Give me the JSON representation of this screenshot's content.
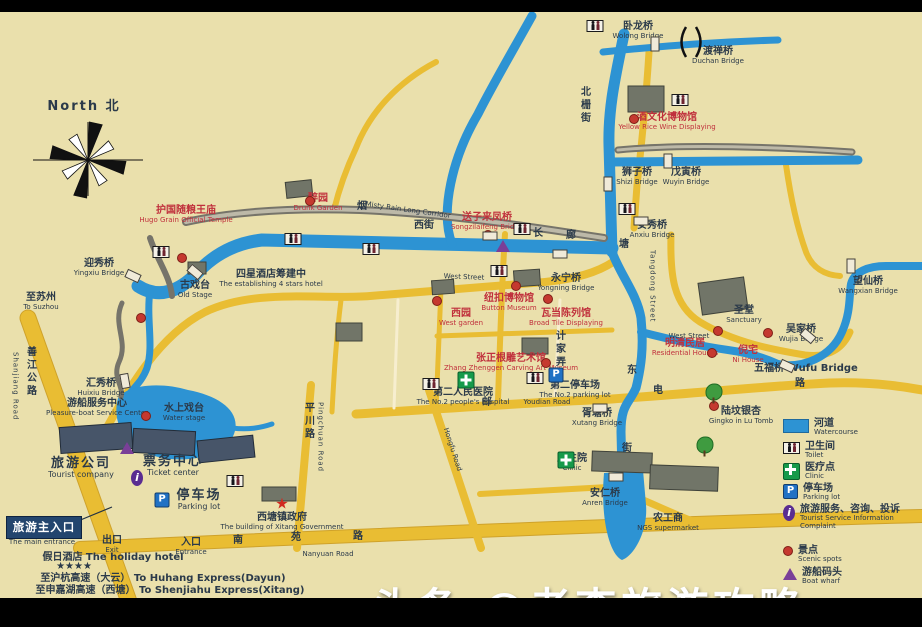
{
  "colors": {
    "background": "#eae0ac",
    "water": "#2d93d3",
    "road": "#e9bd33",
    "red_label": "#c0303c",
    "dark_label": "#2b3a4a",
    "entrance_box": "#23456e",
    "scenic_dot": "#c5392f",
    "clinic_green": "#169a4a",
    "parking_blue": "#2071c4",
    "info_purple": "#5a2d91",
    "wharf_purple": "#7a3f98",
    "watermark": "#ffffff"
  },
  "watermark": {
    "text": "头条 @老李旅游攻略"
  },
  "main_entrance": {
    "zh": "旅游主入口",
    "en": "The main entrance"
  },
  "legend": {
    "items": [
      {
        "icon": "water",
        "zh": "河道",
        "en": "Watercourse"
      },
      {
        "icon": "toilet",
        "zh": "卫生间",
        "en": "Toilet"
      },
      {
        "icon": "cross",
        "zh": "医疗点",
        "en": "Clinic"
      },
      {
        "icon": "parking",
        "zh": "停车场",
        "en": "Parking lot"
      },
      {
        "icon": "info",
        "zh": "旅游服务、咨询、投诉",
        "en": "Tourist Service Information Complaint"
      },
      {
        "icon": "dot",
        "zh": "景点",
        "en": "Scenic spots"
      },
      {
        "icon": "wharf",
        "zh": "游船码头",
        "en": "Boat wharf"
      }
    ]
  },
  "map": {
    "labels": [
      {
        "id": "wolong-bridge",
        "zh": "卧龙桥",
        "en": "Wolong Bridge",
        "x": 638,
        "y": 22
      },
      {
        "id": "duchan-bridge",
        "zh": "渡禅桥",
        "en": "Duchan Bridge",
        "x": 718,
        "y": 47
      },
      {
        "id": "wine-museum",
        "zh": "酒文化博物馆",
        "en": "Yellow Rice Wine Displaying",
        "x": 667,
        "y": 113,
        "red": true
      },
      {
        "id": "beizha-street",
        "zh": "北栅街",
        "x": 578,
        "y": 86,
        "vertical": true
      },
      {
        "id": "shizi-bridge",
        "zh": "狮子桥",
        "en": "Shizi Bridge",
        "x": 637,
        "y": 168
      },
      {
        "id": "wuyin-bridge",
        "zh": "戊寅桥",
        "en": "Wuyin Bridge",
        "x": 686,
        "y": 168
      },
      {
        "id": "anxiu-bridge",
        "zh": "安秀桥",
        "en": "Anxiu Bridge",
        "x": 652,
        "y": 221
      },
      {
        "id": "north-mark",
        "zh": "North 北",
        "x": 84,
        "y": 100,
        "big": true
      },
      {
        "id": "hugo-temple",
        "zh": "护国随粮王庙",
        "en": "Hugo Grain Official Temple",
        "x": 186,
        "y": 206,
        "red": true
      },
      {
        "id": "yingxiu-bridge",
        "zh": "迎秀桥",
        "en": "Yingxiu Bridge",
        "x": 99,
        "y": 259
      },
      {
        "id": "to-suzhou",
        "zh": "至苏州",
        "en": "To Suzhou",
        "x": 41,
        "y": 293
      },
      {
        "id": "shanjiang-road",
        "zh": "善江公路",
        "x": 24,
        "y": 346,
        "vertical": true
      },
      {
        "id": "shanjiang-road-en",
        "en": "Shanjiang Road",
        "x": 11,
        "y": 352,
        "vertical": true
      },
      {
        "id": "zuiyuan-garden",
        "zh": "醉园",
        "en": "Drunk Garden",
        "x": 318,
        "y": 194,
        "red": true
      },
      {
        "id": "corridor-char-yan",
        "zh": "烟",
        "x": 362,
        "y": 202
      },
      {
        "id": "corridor-en",
        "en": "Misty Rain Long Corridor",
        "x": 408,
        "y": 207,
        "rot": 8
      },
      {
        "id": "corridor-char-chang",
        "zh": "长",
        "x": 538,
        "y": 229
      },
      {
        "id": "corridor-char-lang",
        "zh": "廊",
        "x": 571,
        "y": 231
      },
      {
        "id": "songzi-laifeng-bridge",
        "zh": "送子来凤桥",
        "en": "Songzilaifeng Bridge",
        "x": 487,
        "y": 213,
        "red": true
      },
      {
        "id": "old-stage",
        "zh": "古戏台",
        "en": "Old Stage",
        "x": 195,
        "y": 281
      },
      {
        "id": "hotel-4stars",
        "zh": "四星酒店筹建中",
        "en": "The establishing 4 stars hotel",
        "x": 271,
        "y": 270
      },
      {
        "id": "west-street-zh",
        "zh": "西街",
        "x": 424,
        "y": 221
      },
      {
        "id": "west-street-en",
        "en": "West  Street",
        "x": 464,
        "y": 274,
        "rot": 2
      },
      {
        "id": "yongning-bridge",
        "zh": "永宁桥",
        "en": "Yongning Bridge",
        "x": 566,
        "y": 274
      },
      {
        "id": "button-museum",
        "zh": "纽扣博物馆",
        "en": "Button Museum",
        "x": 509,
        "y": 294,
        "red": true
      },
      {
        "id": "wadang-hall",
        "zh": "瓦当陈列馆",
        "en": "Broad Tile Displaying",
        "x": 566,
        "y": 309,
        "red": true
      },
      {
        "id": "west-garden",
        "zh": "西园",
        "en": "West garden",
        "x": 461,
        "y": 309,
        "red": true
      },
      {
        "id": "root-carving-museum",
        "zh": "张正根雕艺术馆",
        "en": "Zhang Zhenggen Carving Art Museum",
        "x": 511,
        "y": 354,
        "red": true
      },
      {
        "id": "jijia-lane",
        "zh": "计家弄",
        "x": 553,
        "y": 330,
        "vertical": true
      },
      {
        "id": "hospital-no2",
        "zh": "第二人民医院",
        "en": "The No.2 people's hospital",
        "x": 463,
        "y": 388
      },
      {
        "id": "parking-no2",
        "zh": "第二停车场",
        "en": "The No.2 parking lot",
        "x": 575,
        "y": 381
      },
      {
        "id": "youdian-char-you",
        "zh": "邮",
        "x": 487,
        "y": 398
      },
      {
        "id": "youdian-road-en",
        "en": "Youdian Road",
        "x": 547,
        "y": 399
      },
      {
        "id": "youdian-char-dian",
        "zh": "电",
        "x": 658,
        "y": 386
      },
      {
        "id": "youdian-char-lu",
        "zh": "路",
        "x": 800,
        "y": 379
      },
      {
        "id": "xutang-bridge",
        "zh": "胥塘桥",
        "en": "Xutang Bridge",
        "x": 597,
        "y": 409
      },
      {
        "id": "clinic-point",
        "zh": "卫生院",
        "en": "Clinic",
        "x": 572,
        "y": 454
      },
      {
        "id": "anren-bridge",
        "zh": "安仁桥",
        "en": "Anren Bridge",
        "x": 605,
        "y": 489
      },
      {
        "id": "tangdong-street-en",
        "en": "Tangdong Street",
        "x": 648,
        "y": 250,
        "vertical": true
      },
      {
        "id": "tangdong-char-tang",
        "zh": "塘",
        "x": 624,
        "y": 240
      },
      {
        "id": "tangdong-char-dong",
        "zh": "东",
        "x": 632,
        "y": 366
      },
      {
        "id": "tangdong-char-jie",
        "zh": "街",
        "x": 627,
        "y": 444
      },
      {
        "id": "ngs-supermarket",
        "zh": "农工商",
        "en": "NGS supermarket",
        "x": 668,
        "y": 514
      },
      {
        "id": "sanctuary",
        "zh": "圣堂",
        "en": "Sanctuary",
        "x": 744,
        "y": 306
      },
      {
        "id": "wujia-bridge",
        "zh": "吴家桥",
        "en": "Wujia Bridge",
        "x": 801,
        "y": 325
      },
      {
        "id": "wangxian-bridge",
        "zh": "望仙桥",
        "en": "Wangxian Bridge",
        "x": 868,
        "y": 277
      },
      {
        "id": "wufu-bridge",
        "zh": "五福桥 Wufu Bridge",
        "x": 806,
        "y": 364
      },
      {
        "id": "ni-house",
        "zh": "倪宅",
        "en": "Ni House",
        "x": 748,
        "y": 346,
        "red": true
      },
      {
        "id": "mingqing-houses",
        "zh": "明清民居",
        "en": "Residential Houses",
        "x": 685,
        "y": 339,
        "red": true
      },
      {
        "id": "gingko-lu-tomb",
        "zh": "陆坟银杏",
        "en": "Gingko in Lu Tomb",
        "x": 741,
        "y": 407
      },
      {
        "id": "huixiu-bridge",
        "zh": "汇秀桥",
        "en": "Huixiu Bridge",
        "x": 101,
        "y": 379
      },
      {
        "id": "boat-service-center",
        "zh": "游船服务中心",
        "en": "Pleasure-boat Service Center",
        "x": 97,
        "y": 399
      },
      {
        "id": "water-stage",
        "zh": "水上戏台",
        "en": "Water stage",
        "x": 184,
        "y": 404
      },
      {
        "id": "tourist-company",
        "zh": "旅游公司",
        "en": "Tourist company",
        "x": 81,
        "y": 457,
        "big": true
      },
      {
        "id": "ticket-center",
        "zh": "票务中心",
        "en": "Ticket center",
        "x": 173,
        "y": 455,
        "big": true
      },
      {
        "id": "parking-main",
        "zh": "停车场",
        "en": "Parking lot",
        "x": 199,
        "y": 489,
        "big": true
      },
      {
        "id": "main-entrance-en",
        "en": "The main entrance",
        "x": 42,
        "y": 539
      },
      {
        "id": "exit-gate",
        "zh": "出口",
        "en": "Exit",
        "x": 112,
        "y": 536
      },
      {
        "id": "entrance-gate",
        "zh": "入口",
        "en": "Entrance",
        "x": 191,
        "y": 538
      },
      {
        "id": "gov-building",
        "zh": "西塘镇政府",
        "en": "The building of Xitang Government",
        "x": 282,
        "y": 513
      },
      {
        "id": "holiday-hotel",
        "zh": "假日酒店 The holiday hotel",
        "x": 113,
        "y": 553
      },
      {
        "id": "hotel-stars",
        "zh": "★★★★",
        "x": 74,
        "y": 562
      },
      {
        "id": "huhang-express",
        "zh": "至沪杭高速（大云） To Huhang Express(Dayun)",
        "x": 163,
        "y": 574
      },
      {
        "id": "shenjiahu-express",
        "zh": "至申嘉湖高速（西塘） To Shenjiahu Express(Xitang)",
        "x": 170,
        "y": 586
      },
      {
        "id": "nanyuan-char-nan",
        "zh": "南",
        "x": 238,
        "y": 536
      },
      {
        "id": "nanyuan-char-yuan",
        "zh": "苑",
        "x": 296,
        "y": 533
      },
      {
        "id": "nanyuan-char-lu",
        "zh": "路",
        "x": 358,
        "y": 532
      },
      {
        "id": "nanyuan-road-en",
        "en": "Nanyuan Road",
        "x": 328,
        "y": 551
      },
      {
        "id": "pingchuan-road",
        "zh": "平川路",
        "x": 302,
        "y": 402,
        "vertical": true
      },
      {
        "id": "pingchuan-road-en",
        "en": "Pingchuan Road",
        "x": 316,
        "y": 402,
        "vertical": true
      },
      {
        "id": "hongfu-road-en",
        "en": "Hongfu Road",
        "x": 452,
        "y": 446,
        "rot": 72
      },
      {
        "id": "west-street-2",
        "en": "West  Street",
        "x": 689,
        "y": 333
      }
    ],
    "markers": {
      "toilets": [
        [
          595,
          26
        ],
        [
          680,
          100
        ],
        [
          627,
          209
        ],
        [
          522,
          229
        ],
        [
          293,
          239
        ],
        [
          371,
          249
        ],
        [
          161,
          252
        ],
        [
          499,
          271
        ],
        [
          535,
          378
        ],
        [
          431,
          384
        ],
        [
          235,
          481
        ]
      ],
      "scenic_dots": [
        [
          182,
          258
        ],
        [
          141,
          318
        ],
        [
          146,
          416
        ],
        [
          310,
          201
        ],
        [
          488,
          235
        ],
        [
          516,
          286
        ],
        [
          548,
          299
        ],
        [
          437,
          301
        ],
        [
          546,
          363
        ],
        [
          634,
          119
        ],
        [
          718,
          331
        ],
        [
          768,
          333
        ],
        [
          712,
          353
        ],
        [
          714,
          406
        ]
      ],
      "crosses": [
        [
          466,
          380
        ],
        [
          566,
          443
        ]
      ],
      "parking": [
        [
          162,
          500
        ],
        [
          556,
          375
        ]
      ],
      "info": [
        [
          137,
          478
        ]
      ],
      "wharfs": [
        [
          127,
          448
        ],
        [
          503,
          246
        ]
      ],
      "trees": [
        [
          714,
          358
        ],
        [
          705,
          394
        ]
      ],
      "star": [
        282,
        504
      ]
    }
  }
}
